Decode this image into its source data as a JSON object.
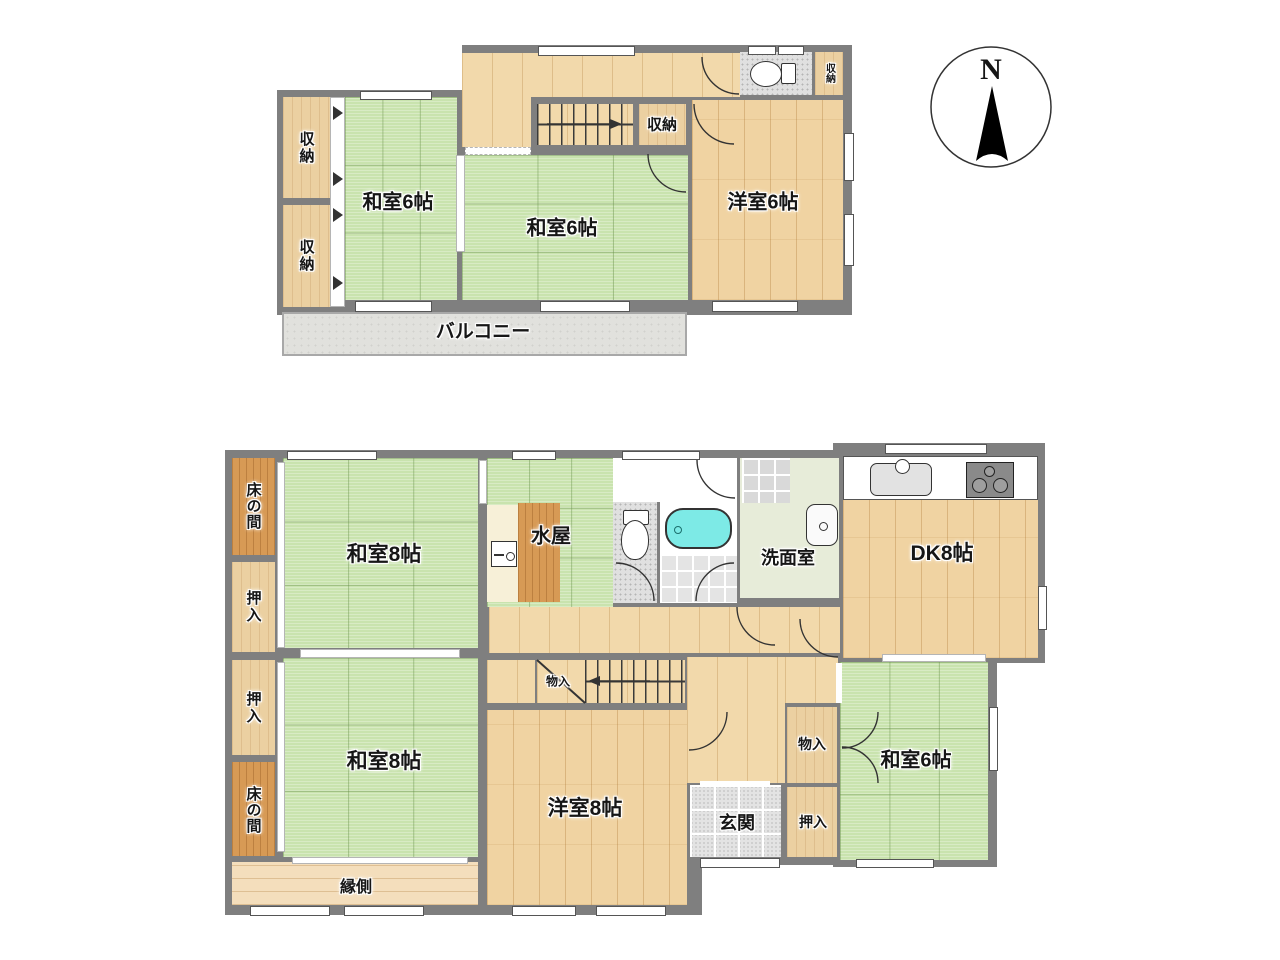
{
  "compass": {
    "north_label": "N"
  },
  "floor2": {
    "storage_a": "収納",
    "storage_b": "収納",
    "washitsu_a": "和室6帖",
    "washitsu_b": "和室6帖",
    "storage_stairs": "収納",
    "storage_wc": "収納",
    "youshitsu": "洋室6帖",
    "balcony": "バルコニー"
  },
  "floor1": {
    "tokonoma_a": "床の間",
    "oshiire_a": "押入",
    "oshiire_b": "押入",
    "tokonoma_b": "床の間",
    "washitsu8_a": "和室8帖",
    "washitsu8_b": "和室8帖",
    "mizuya": "水屋",
    "washroom": "洗面室",
    "dk": "DK8帖",
    "stairs_storage": "物入",
    "storage": "物入",
    "oshiire_c": "押入",
    "washitsu6": "和室6帖",
    "genkan": "玄関",
    "engawa": "縁側",
    "youshitsu8": "洋室8帖"
  },
  "icons": {
    "toilet_2f": "toilet-icon",
    "toilet_1f": "toilet-icon",
    "bathtub": "bathtub-icon",
    "washbasin": "washbasin-icon",
    "mizuya_sink": "sink-icon",
    "kitchen_sink": "kitchen-sink-icon",
    "stove": "stove-icon",
    "compass": "north-arrow-icon"
  },
  "colors": {
    "tatami": "#c9e3ae",
    "wood": "#f0d3a2",
    "hall_wood": "#f2d9ab",
    "engawa_wood": "#f4debc",
    "dark_wood": "#d79a55",
    "closet_wood": "#ebd0a1",
    "wall": "#7f7f7f",
    "balcony": "#e1e1dd",
    "bathtub": "#7deae6",
    "washroom_floor": "#e7ecd9",
    "tile": "#e3e3e3"
  }
}
